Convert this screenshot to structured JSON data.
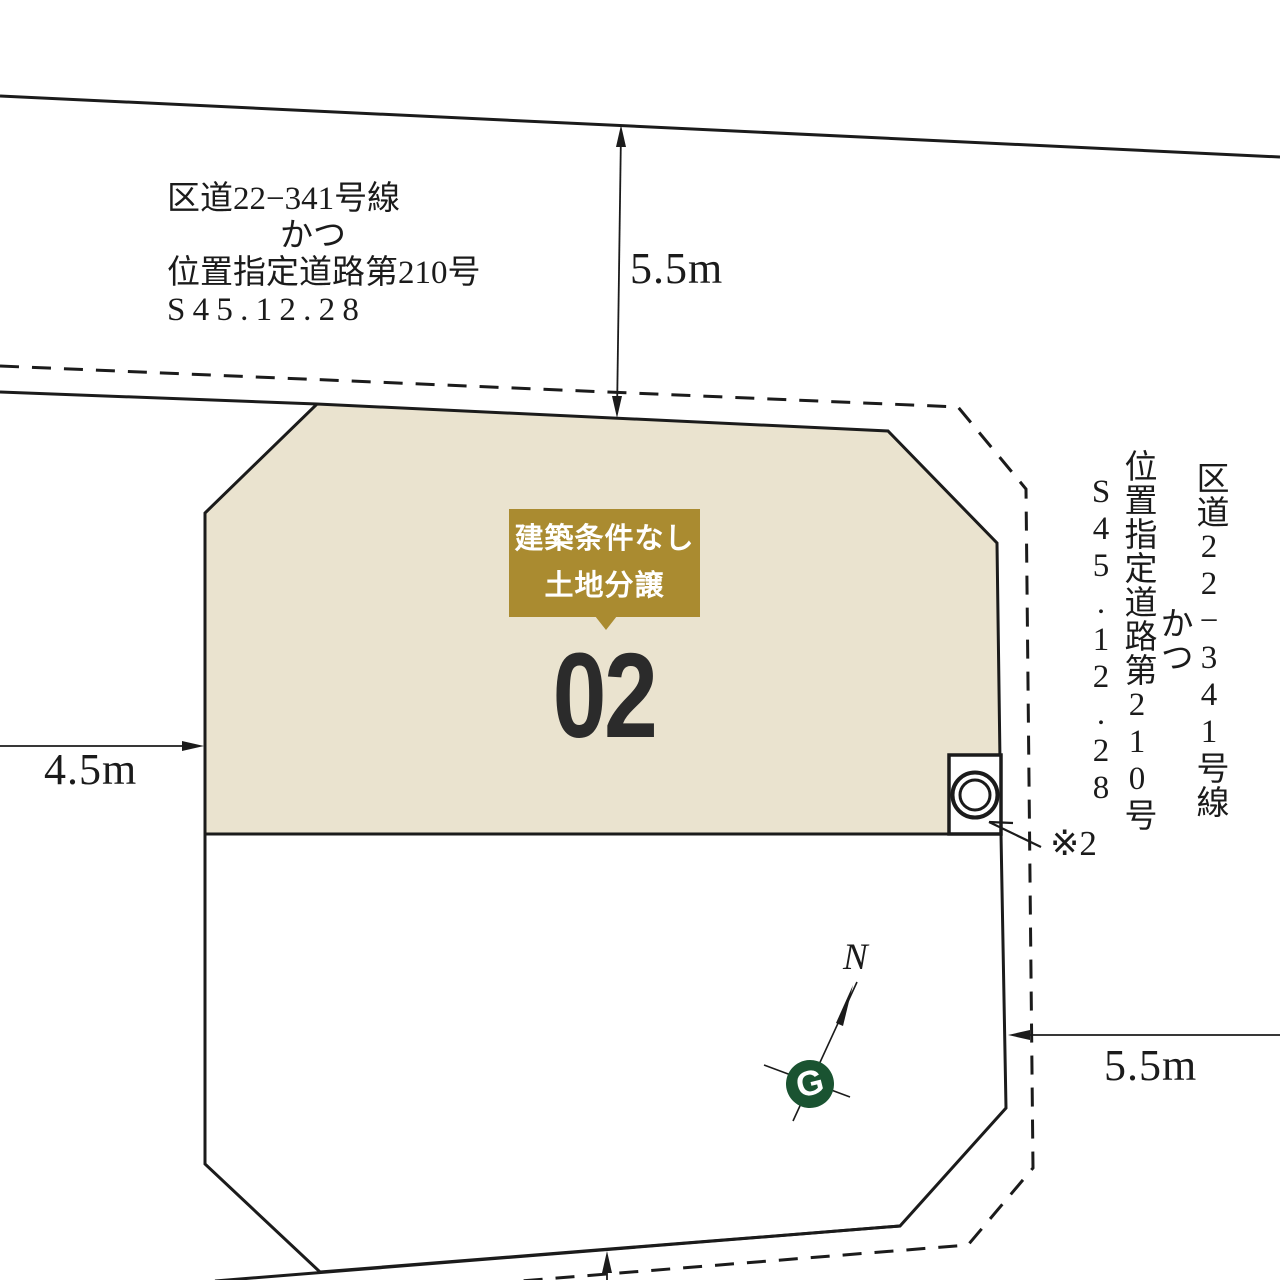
{
  "diagram_title": "分譲区画図 (land plot layout)",
  "plot": {
    "number": "02",
    "badge": {
      "line1": "建築条件なし",
      "line2": "土地分譲"
    }
  },
  "roads": {
    "top_label": {
      "lines": [
        "区道22−341号線",
        "かつ",
        "位置指定道路第210号",
        "S45.12.28"
      ]
    },
    "right_label": {
      "lines": [
        "区道22−341号線",
        "かつ",
        "位置指定道路第210号",
        "S45.12.28"
      ]
    }
  },
  "dimensions": {
    "top_road_width": "5.5m",
    "left_road_width": "4.5m",
    "right_road_width": "5.5m"
  },
  "annotations": {
    "note": "※2",
    "north": "N",
    "logo_letter": "G"
  },
  "icons": {
    "manhole": "double-circle-in-box",
    "north_arrow": "survey-needle",
    "company_logo": "green-circle-G"
  },
  "colors": {
    "plot_fill": "#eae3cf",
    "badge_gold": "#aa8b30",
    "plot_number_ink": "#2b2b2b",
    "logo_green": "#1a5331",
    "line_ink": "#1b1b1b",
    "background": "#ffffff"
  }
}
